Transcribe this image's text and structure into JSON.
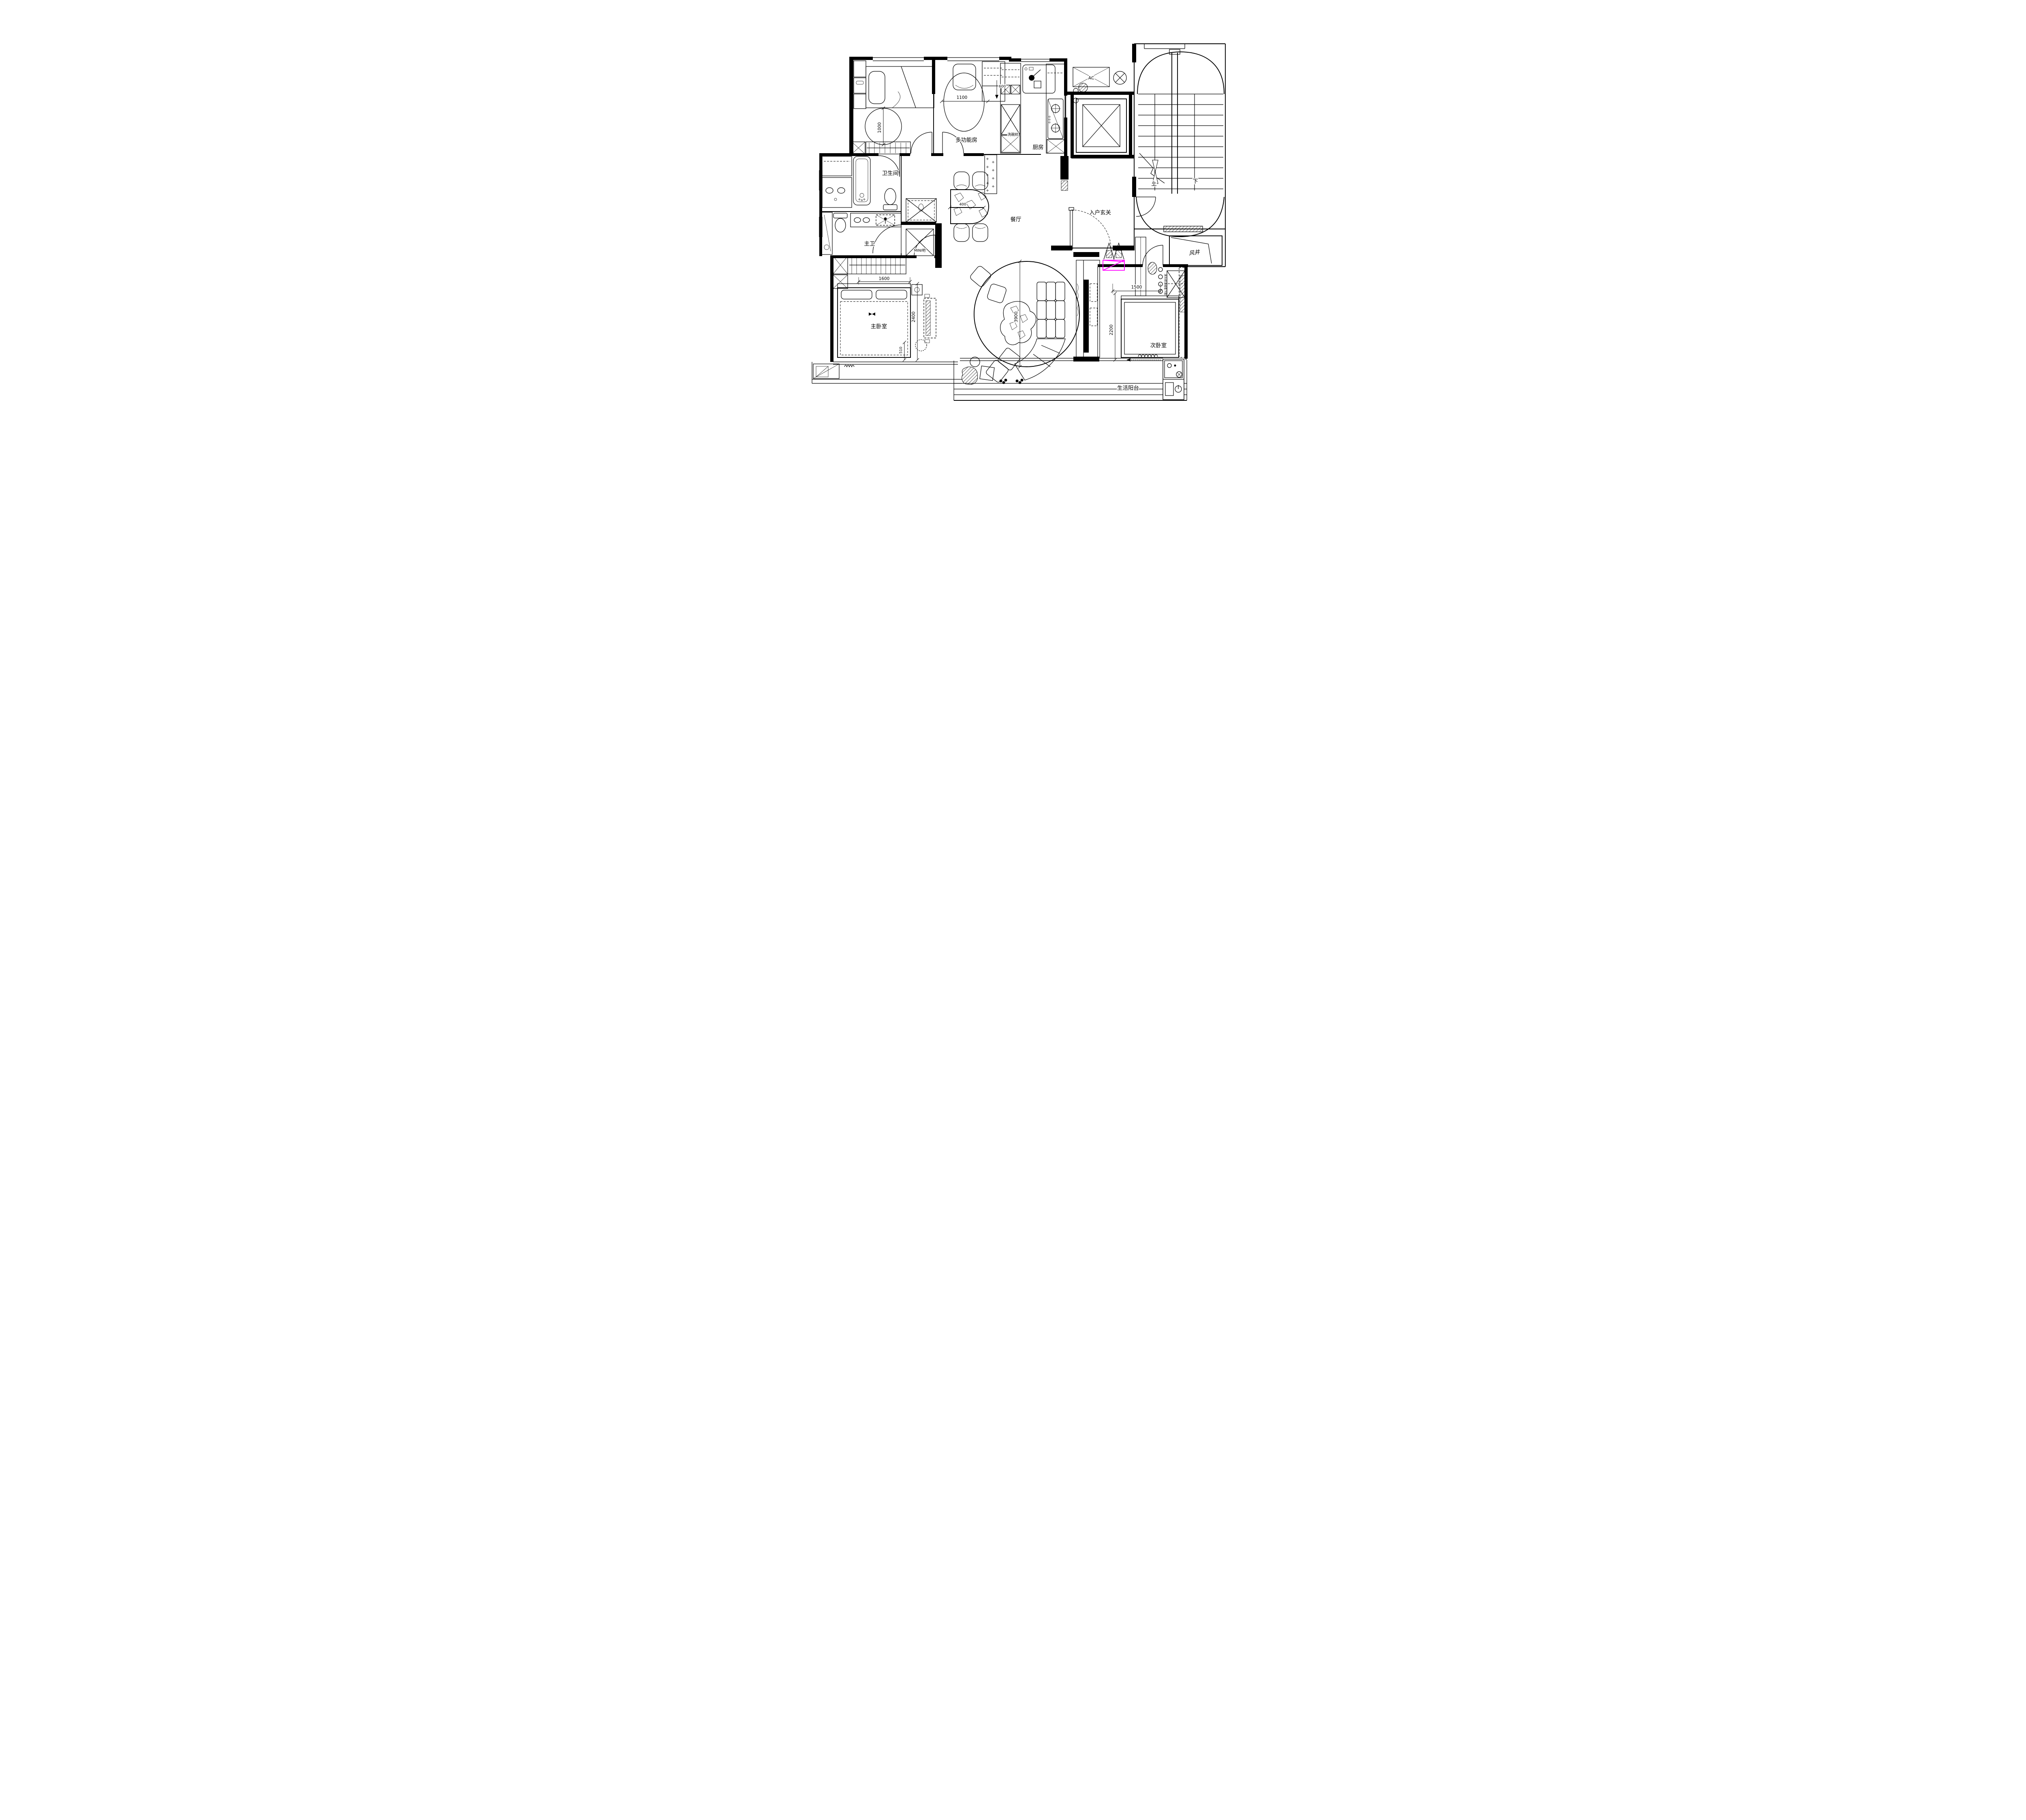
{
  "drawing": {
    "type": "apartment-floor-plan",
    "background": "#ffffff",
    "line_color": "#000000",
    "highlight_color": "#ff00ff"
  },
  "rooms": {
    "multi_function": "多功能房",
    "kitchen": "厨房",
    "bathroom": "卫生间",
    "master_bath": "主卫",
    "mini_bar": "MINI吧",
    "dining": "餐厅",
    "foyer": "入户玄关",
    "wind_shaft": "风井",
    "master_bedroom": "主卧室",
    "second_bedroom": "次卧室",
    "balcony": "生活阳台"
  },
  "fixtures": {
    "dishwasher": "洗碗机",
    "ac_unit": "AC"
  },
  "stairs": {
    "up_label": "上",
    "down_label": "下"
  },
  "dimensions": {
    "multifunction_table": "1100",
    "multifunction_cabinet": "600",
    "bedroom_rug": "1000",
    "dining_table": "400",
    "master_bed_width": "1600",
    "master_room_depth": "2400",
    "master_bed_offset": "510",
    "living_rug": "3900",
    "second_bed_width": "1500",
    "second_room_depth": "2200"
  },
  "annotations": {
    "bedside_cabinet_note": "床头柜详细看下图"
  }
}
